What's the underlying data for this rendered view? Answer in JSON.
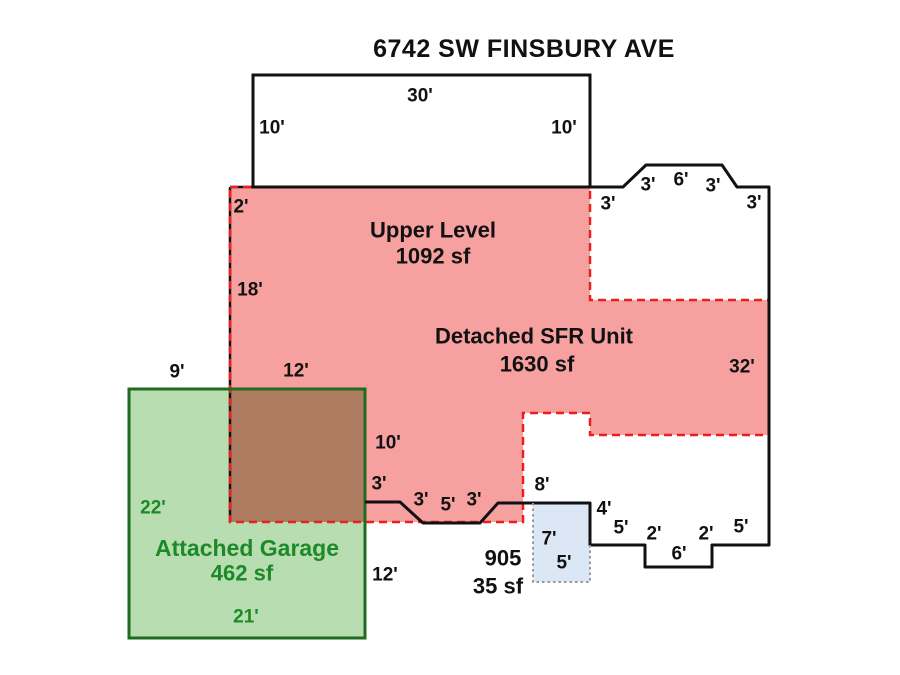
{
  "title": "6742 SW FINSBURY AVE",
  "regions": {
    "upper_level": {
      "name": "Upper Level",
      "area": "1092 sf"
    },
    "detached_sfr": {
      "name": "Detached SFR Unit",
      "area": "1630 sf"
    },
    "attached_garage": {
      "name": "Attached Garage",
      "area": "462 sf"
    },
    "porch": {
      "name": "905",
      "area": "35 sf"
    }
  },
  "colors": {
    "red_fill": "#F6A0A0",
    "red_dash": "#EA1F1F",
    "garage_fill": "#B8DDB0",
    "garage_border": "#1F6B1F",
    "green_text": "#1D8A2A",
    "overlap_fill": "#AE7C60",
    "porch_fill": "#DBE7F4",
    "outline_black": "#111111",
    "porch_dotted": "#999999"
  },
  "labels": [
    {
      "text": "Upper Level",
      "x": 433,
      "y": 230,
      "cls": "region",
      "name": "upper-level-label"
    },
    {
      "text": "1092 sf",
      "x": 433,
      "y": 256,
      "cls": "area",
      "name": "upper-level-area"
    },
    {
      "text": "Detached SFR Unit",
      "x": 534,
      "y": 336,
      "cls": "region",
      "name": "detached-sfr-label"
    },
    {
      "text": "1630 sf",
      "x": 537,
      "y": 364,
      "cls": "area",
      "name": "detached-sfr-area"
    },
    {
      "text": "Attached Garage",
      "x": 247,
      "y": 548,
      "cls": "region-g",
      "name": "attached-garage-label"
    },
    {
      "text": "462 sf",
      "x": 242,
      "y": 573,
      "cls": "area-g",
      "name": "attached-garage-area"
    },
    {
      "text": "905",
      "x": 503,
      "y": 558,
      "cls": "area",
      "name": "porch-label"
    },
    {
      "text": "35 sf",
      "x": 498,
      "y": 586,
      "cls": "area",
      "name": "porch-area"
    },
    {
      "text": "30'",
      "x": 420,
      "y": 95,
      "cls": "dim",
      "name": "dim-top-30"
    },
    {
      "text": "10'",
      "x": 272,
      "y": 127,
      "cls": "dim",
      "name": "dim-upper-left-10"
    },
    {
      "text": "10'",
      "x": 564,
      "y": 127,
      "cls": "dim",
      "name": "dim-upper-right-10"
    },
    {
      "text": "2'",
      "x": 241,
      "y": 206,
      "cls": "dim",
      "name": "dim-2"
    },
    {
      "text": "3'",
      "x": 608,
      "y": 203,
      "cls": "dim",
      "name": "dim-bay-left-3"
    },
    {
      "text": "3'",
      "x": 648,
      "y": 184,
      "cls": "dim",
      "name": "dim-bay-diag-left-3"
    },
    {
      "text": "6'",
      "x": 681,
      "y": 179,
      "cls": "dim",
      "name": "dim-bay-top-6"
    },
    {
      "text": "3'",
      "x": 713,
      "y": 185,
      "cls": "dim",
      "name": "dim-bay-diag-right-3"
    },
    {
      "text": "3'",
      "x": 754,
      "y": 202,
      "cls": "dim",
      "name": "dim-bay-right-3"
    },
    {
      "text": "18'",
      "x": 250,
      "y": 289,
      "cls": "dim",
      "name": "dim-left-18"
    },
    {
      "text": "32'",
      "x": 742,
      "y": 366,
      "cls": "dim",
      "name": "dim-right-32"
    },
    {
      "text": "9'",
      "x": 177,
      "y": 371,
      "cls": "dim",
      "name": "dim-garage-top-9"
    },
    {
      "text": "12'",
      "x": 296,
      "y": 370,
      "cls": "dim",
      "name": "dim-garage-top-12"
    },
    {
      "text": "10'",
      "x": 388,
      "y": 442,
      "cls": "dim",
      "name": "dim-mid-10"
    },
    {
      "text": "3'",
      "x": 379,
      "y": 483,
      "cls": "dim",
      "name": "dim-mid-3"
    },
    {
      "text": "3'",
      "x": 421,
      "y": 499,
      "cls": "dim",
      "name": "dim-bottom-diag-left-3"
    },
    {
      "text": "5'",
      "x": 448,
      "y": 504,
      "cls": "dim",
      "name": "dim-bottom-flat-5"
    },
    {
      "text": "3'",
      "x": 474,
      "y": 499,
      "cls": "dim",
      "name": "dim-bottom-diag-right-3"
    },
    {
      "text": "8'",
      "x": 542,
      "y": 484,
      "cls": "dim",
      "name": "dim-bottom-8"
    },
    {
      "text": "4'",
      "x": 604,
      "y": 508,
      "cls": "dim",
      "name": "dim-step-4"
    },
    {
      "text": "5'",
      "x": 621,
      "y": 527,
      "cls": "dim",
      "name": "dim-step-left-5"
    },
    {
      "text": "2'",
      "x": 654,
      "y": 533,
      "cls": "dim",
      "name": "dim-notch-left-2"
    },
    {
      "text": "6'",
      "x": 679,
      "y": 553,
      "cls": "dim",
      "name": "dim-notch-6"
    },
    {
      "text": "2'",
      "x": 706,
      "y": 533,
      "cls": "dim",
      "name": "dim-notch-right-2"
    },
    {
      "text": "5'",
      "x": 741,
      "y": 526,
      "cls": "dim",
      "name": "dim-step-right-5"
    },
    {
      "text": "7'",
      "x": 549,
      "y": 538,
      "cls": "dim",
      "name": "dim-porch-7"
    },
    {
      "text": "5'",
      "x": 564,
      "y": 562,
      "cls": "dim",
      "name": "dim-porch-5"
    },
    {
      "text": "12'",
      "x": 385,
      "y": 574,
      "cls": "dim",
      "name": "dim-garage-right-12"
    },
    {
      "text": "22'",
      "x": 153,
      "y": 507,
      "cls": "dim-g",
      "name": "dim-garage-left-22"
    },
    {
      "text": "21'",
      "x": 246,
      "y": 616,
      "cls": "dim-g",
      "name": "dim-garage-bottom-21"
    }
  ]
}
